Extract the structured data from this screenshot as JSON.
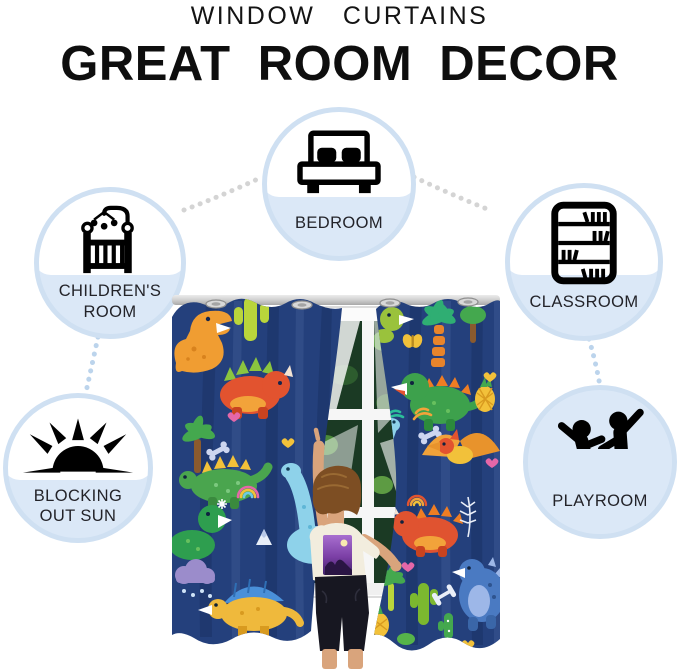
{
  "header": {
    "kicker": "WINDOW  CURTAINS",
    "title": "GREAT  ROOM  DECOR"
  },
  "features": [
    {
      "id": "bedroom",
      "icon": "bed-icon",
      "label": "BEDROOM",
      "lines": [
        "BEDROOM"
      ]
    },
    {
      "id": "childrens-room",
      "icon": "crib-icon",
      "label": "CHILDREN'S ROOM",
      "lines": [
        "CHILDREN'S",
        "ROOM"
      ]
    },
    {
      "id": "classroom",
      "icon": "bookshelf-icon",
      "label": "CLASSROOM",
      "lines": [
        "CLASSROOM"
      ]
    },
    {
      "id": "blocking-out-sun",
      "icon": "sun-icon",
      "label": "BLOCKING OUT SUN",
      "lines": [
        "BLOCKING",
        "OUT SUN"
      ]
    },
    {
      "id": "playroom",
      "icon": "playing-children-icon",
      "label": "PLAYROOM",
      "lines": [
        "PLAYROOM"
      ]
    }
  ],
  "photo": {
    "alt": "Child reaching up to navy blue dinosaur print grommet curtains hanging on a rod in front of a white window"
  },
  "palette": {
    "bubble_ring": "#cfe0f2",
    "bubble_fill": "#dbe8f7",
    "connector_gray": "#d4d4d4",
    "connector_blue": "#bcd4ec",
    "curtain_navy": "#24407c",
    "dino_orange": "#f09d32",
    "dino_red": "#e2532f",
    "dino_green": "#3da14c",
    "dino_teal": "#8ed2ea",
    "dino_yellow": "#efb93c",
    "dino_blue": "#4a7ac2",
    "heart_pink": "#e567a8"
  }
}
